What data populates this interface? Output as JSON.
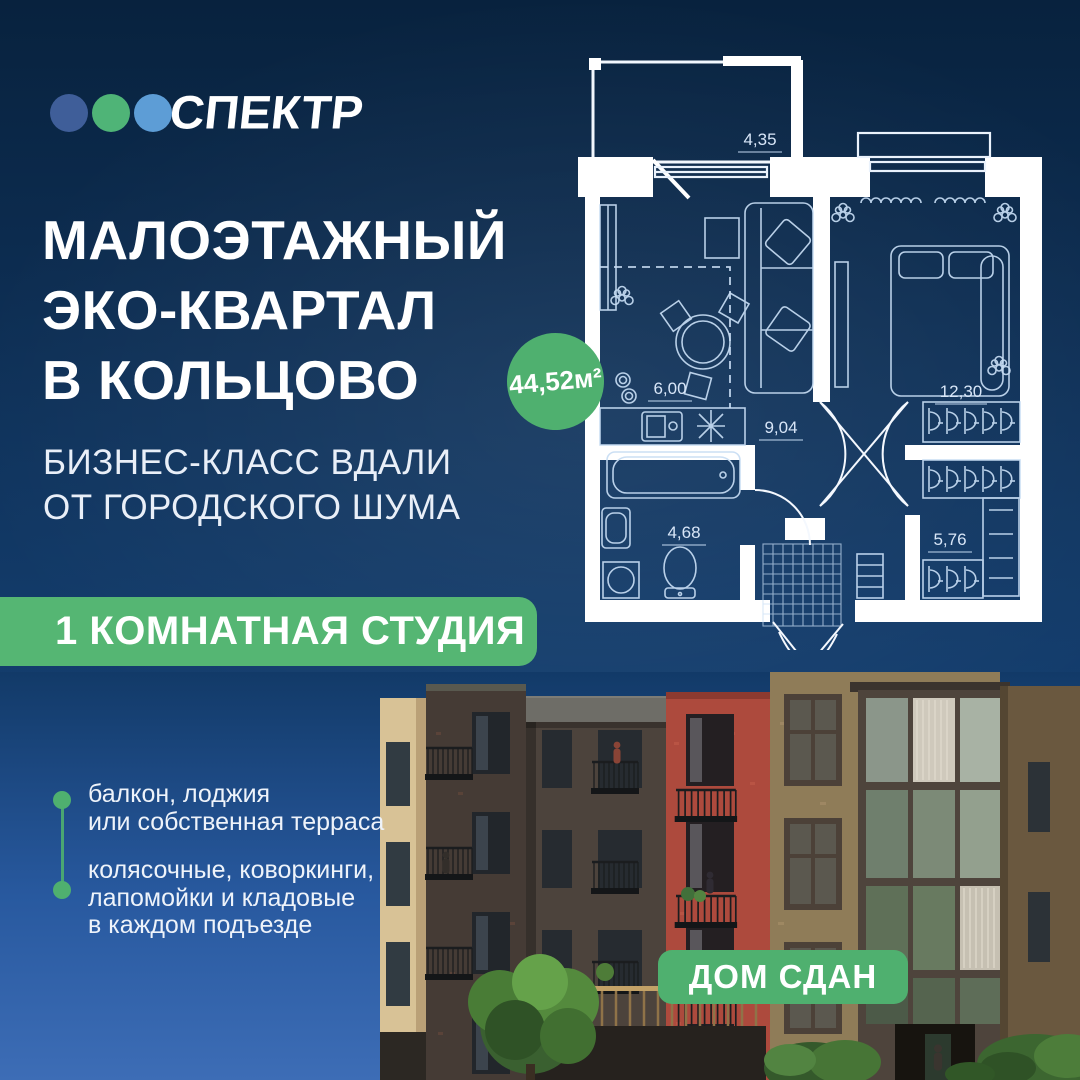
{
  "brand": {
    "name": "СПЕКТР"
  },
  "headline": {
    "line1": "МАЛОЭТАЖНЫЙ",
    "line2": "ЭКО-КВАРТАЛ",
    "line3": "В КОЛЬЦОВО"
  },
  "subtitle": {
    "line1": "БИЗНЕС-КЛАСС ВДАЛИ",
    "line2": "ОТ ГОРОДСКОГО ШУМА"
  },
  "apartment": {
    "type": "1 КОМНАТНАЯ СТУДИЯ",
    "total_area": "44,52м²"
  },
  "floorplan": {
    "areas": {
      "balcony": "4,35",
      "kitchen": "6,00",
      "hall": "9,04",
      "bedroom": "12,30",
      "bathroom": "4,68",
      "wardrobe": "5,76"
    }
  },
  "features": [
    {
      "lines": [
        "балкон, лоджия",
        "или собственная терраса"
      ]
    },
    {
      "lines": [
        "колясочные, коворкинги,",
        "лапомойки и кладовые",
        "в каждом подъезде"
      ]
    }
  ],
  "status": {
    "label": "ДОМ СДАН"
  },
  "colors": {
    "accent-green": "#4FB06F",
    "band-green": "#55B673",
    "dot-blue": "#3F5E99",
    "dot-green": "#4FB477",
    "dot-lightblue": "#5D9DD6",
    "navy-top": "#0A2846",
    "sky-bottom": "#3A6AB4"
  }
}
